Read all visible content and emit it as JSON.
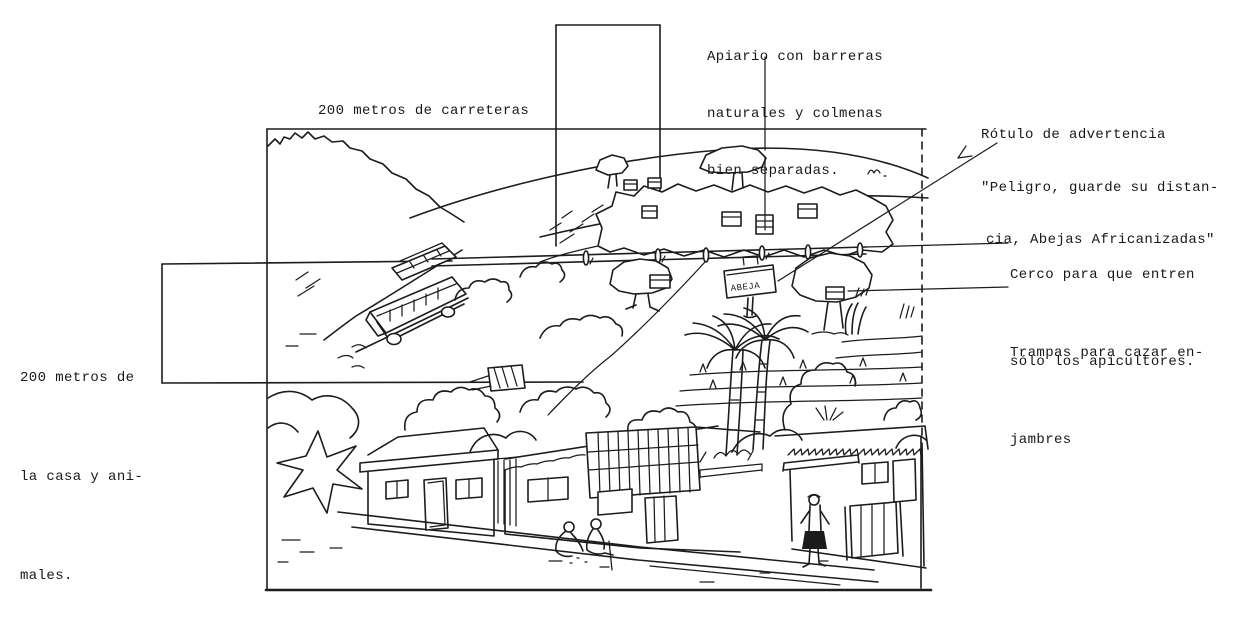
{
  "page": {
    "background": "#ffffff",
    "ink_color": "#1c1c1c",
    "description_labels": "annotated apiary site illustration"
  },
  "labels": {
    "road_distance": "200 metros de carreteras",
    "apiary": {
      "line1": "Apiario con barreras",
      "line2": "naturales y colmenas",
      "line3": "bien separadas."
    },
    "warning_sign": {
      "line1": "Rótulo de advertencia",
      "line2": "\"Peligro, guarde su distan-",
      "line3": "cia, Abejas Africanizadas\""
    },
    "fence": {
      "line1": "Cerco para que entren",
      "line2": "sólo los apicultores."
    },
    "traps": {
      "line1": "Trampas para cazar en-",
      "line2": "jambres"
    },
    "house_distance": {
      "line1": "200 metros de",
      "line2": "la casa y ani-",
      "line3": "males."
    }
  },
  "illustration": {
    "sign_text": "ABEJA"
  }
}
